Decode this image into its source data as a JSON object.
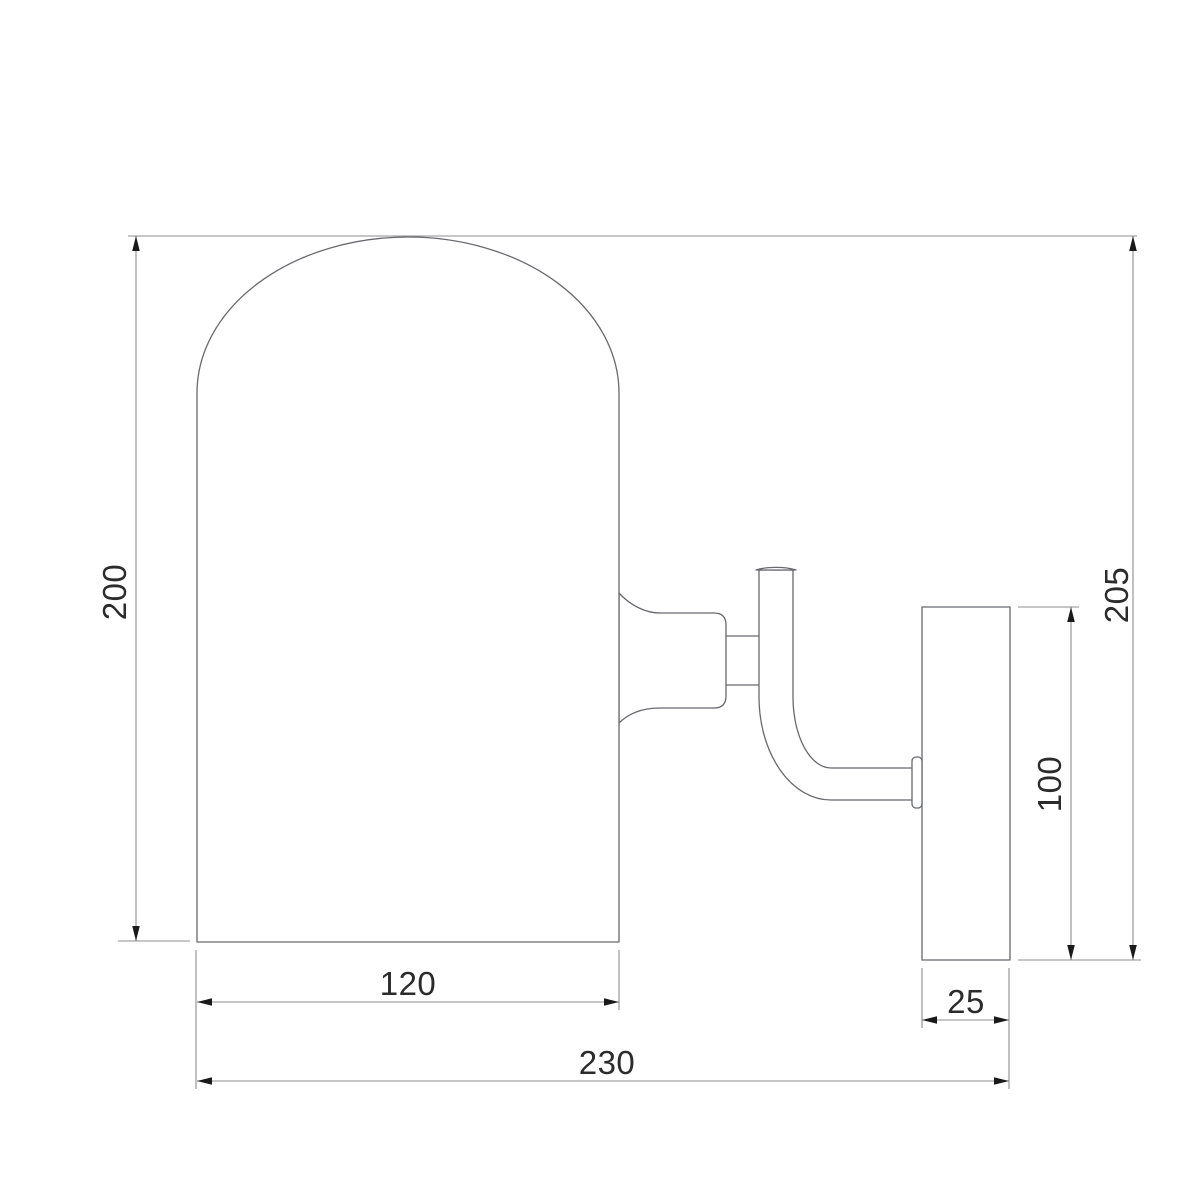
{
  "dimensions": {
    "shade_height": "200",
    "overall_height": "205",
    "backplate_height": "100",
    "shade_width": "120",
    "backplate_depth": "25",
    "overall_width": "230"
  },
  "colors": {
    "background": "#ffffff",
    "object_line": "#67696d",
    "dimension_line": "#8e8e8e",
    "arrow_fill": "#1a1a1a",
    "label_text": "#2b2b2b"
  }
}
